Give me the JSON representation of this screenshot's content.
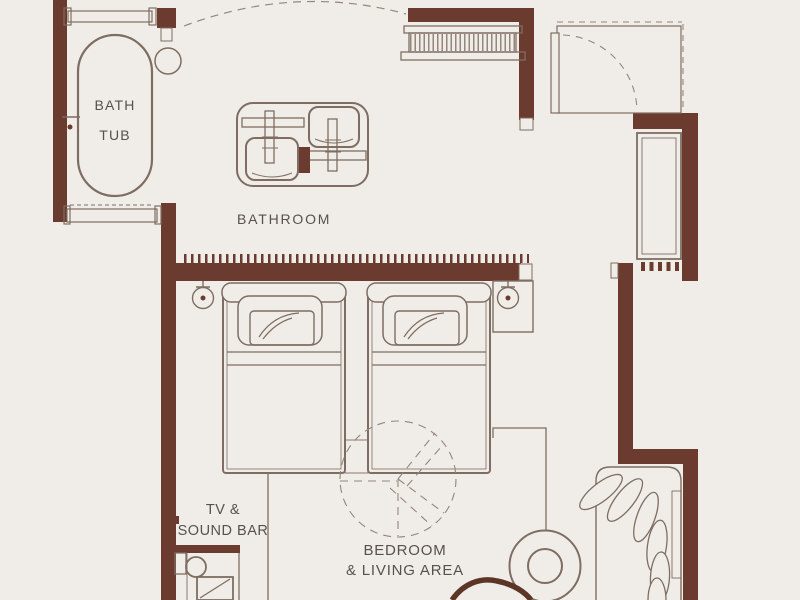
{
  "rooms": {
    "bathroom": {
      "label": "BATHROOM"
    },
    "bedroom_living": {
      "line1": "BEDROOM",
      "line2": "& LIVING AREA"
    }
  },
  "fixtures": {
    "bathtub": {
      "line1": "BATH",
      "line2": "TUB"
    },
    "tv_soundbar": {
      "line1": "TV &",
      "line2": "SOUND BAR"
    }
  },
  "colors": {
    "background": "#f0ede8",
    "wall": "#6a3b2e",
    "line": "#7e6d62",
    "line_light": "#95867b",
    "text": "#57514b"
  }
}
